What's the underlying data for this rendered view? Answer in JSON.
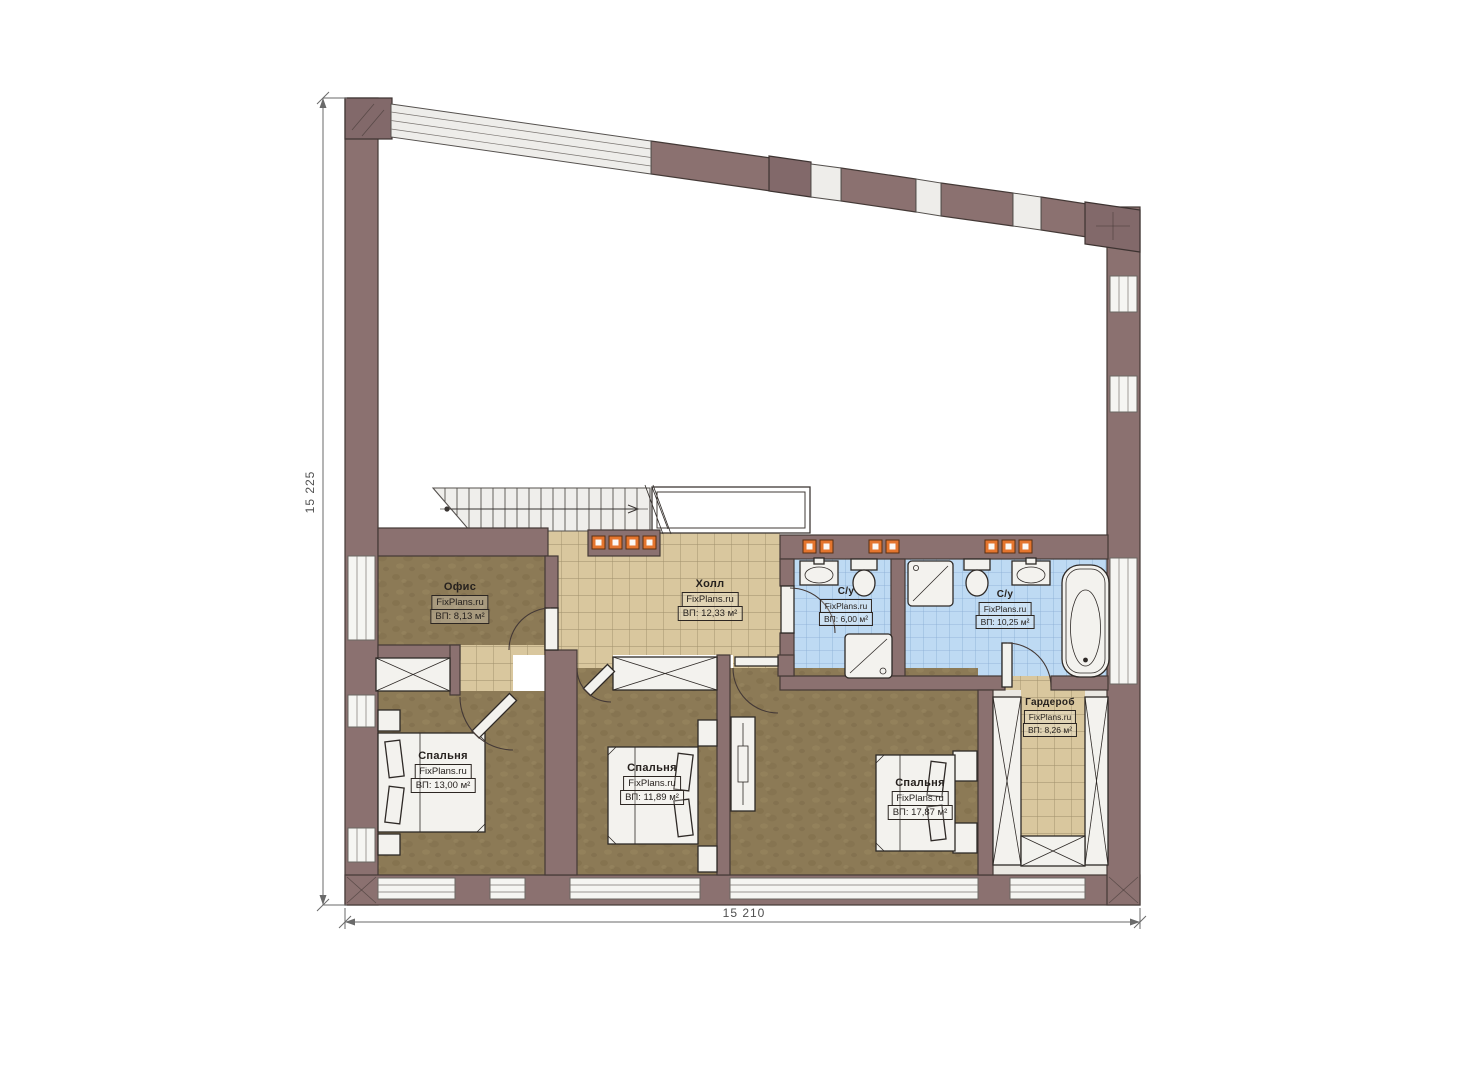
{
  "plan": {
    "watermark": "FixPlans.ru",
    "rooms": [
      {
        "id": "office",
        "name": "Офис",
        "watermark": "FixPlans.ru",
        "area": "ВП: 8,13 м²"
      },
      {
        "id": "hall",
        "name": "Холл",
        "watermark": "FixPlans.ru",
        "area": "ВП: 12,33 м²"
      },
      {
        "id": "bathroom-1",
        "name": "С/у",
        "watermark": "FixPlans.ru",
        "area": "ВП: 6,00 м²"
      },
      {
        "id": "bathroom-2",
        "name": "С/у",
        "watermark": "FixPlans.ru",
        "area": "ВП: 10,25 м²"
      },
      {
        "id": "wardrobe",
        "name": "Гардероб",
        "watermark": "FixPlans.ru",
        "area": "ВП: 8,26 м²"
      },
      {
        "id": "bedroom-1",
        "name": "Спальня",
        "watermark": "FixPlans.ru",
        "area": "ВП: 13,00 м²"
      },
      {
        "id": "bedroom-2",
        "name": "Спальня",
        "watermark": "FixPlans.ru",
        "area": "ВП: 11,89 м²"
      },
      {
        "id": "bedroom-3",
        "name": "Спальня",
        "watermark": "FixPlans.ru",
        "area": "ВП: 17,87 м²"
      }
    ],
    "dimensions": {
      "left": "15 225",
      "bottom": "15 210"
    },
    "palette": {
      "wall": "#8b7170",
      "carpet_floor": "#8c7a56",
      "tile_tan": "#d9c79e",
      "tile_blue": "#bedaf3",
      "radiator": "#e4752e"
    }
  }
}
